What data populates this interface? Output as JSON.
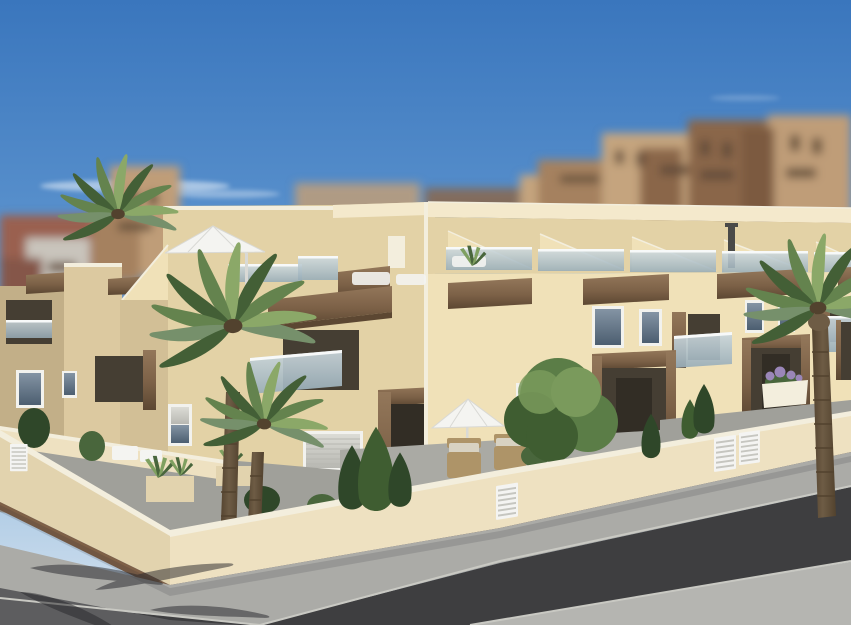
{
  "canvas": {
    "width": 851,
    "height": 625
  },
  "scene": {
    "type": "3d-architectural-exterior-render",
    "subject": "Modern two-storey cream townhouse complex with roof terraces, wooden accents, palm trees and walled front gardens on a street corner; blurred city apartment blocks behind under a blue sky",
    "time_of_day": "day",
    "elements": [
      "blue-sky",
      "wispy-clouds",
      "blurred-city-apartment-blocks",
      "townhouse-row",
      "roof-terraces",
      "sloped-roof-canopies",
      "glass-balustrades",
      "wooden-fascia-beams",
      "roof-cantilever-parasol",
      "roof-access-door",
      "chimney-flue",
      "roof-loungers",
      "balconies",
      "white-framed-windows",
      "roller-shutter-windows",
      "wooden-entrance-portals",
      "garden-walls",
      "wooden-wall-base-trim",
      "white-slatted-gates",
      "front-garden-terraces",
      "cypress-shrubs",
      "planter-boxes",
      "agave-plants",
      "flower-planter",
      "garden-parasol",
      "wicker-armchairs",
      "garden-tree",
      "palm-trees",
      "sidewalk",
      "asphalt-road",
      "far-pavement",
      "palm-frond-shadows"
    ]
  },
  "palette": {
    "skyTop": "#3a76bd",
    "skyUpper": "#5e95cf",
    "skyLower": "#a6c6e2",
    "skyHorizon": "#d6e3f0",
    "cloud": "#ffffff",
    "cityRed": "#9a6150",
    "cityRedDark": "#85564a",
    "cityGray": "#c9c4bc",
    "cityGrayLight": "#cfcbc2",
    "cityTan": "#bf9d78",
    "cityTanLight": "#c5a47e",
    "cityBrown": "#a5815f",
    "cityBrownDark": "#8a664a",
    "cityUmber": "#7c5a40",
    "citySpeck": "#5f4a38",
    "creamBright": "#f0e1b8",
    "creamLight": "#f4e9cc",
    "creamMid": "#e3d2a6",
    "creamShade": "#dcc9a0",
    "creamDark": "#d2bf96",
    "khaki": "#c2af88",
    "offWhite": "#f3eedd",
    "woodMid": "#7c6147",
    "woodLight": "#93775a",
    "woodDark": "#5c4732",
    "glassTop": "#ccd8dd",
    "glassBottom": "#98adb8",
    "railWhite": "#f7f9f9",
    "winFrame": "#f2f2ee",
    "winGlassTop": "#8494a4",
    "winGlassBottom": "#4c5e70",
    "shutterLight": "#dcdcd6",
    "shutterDark": "#b8b8b2",
    "recessDark": "#453e33",
    "doorDark": "#322d25",
    "palmMid": "#64834e",
    "palmDark": "#435f36",
    "palmLight": "#8ba868",
    "palmGray": "#76906b",
    "trunkMid": "#6e5c45",
    "trunkDark": "#52422e",
    "treeMid": "#5b7d47",
    "treeDark": "#3f5d31",
    "treeLight": "#7a9a5c",
    "bushDark": "#2f4729",
    "bushMid": "#49663c",
    "agave": "#7fa060",
    "wallCream": "#eee1c1",
    "wallShade": "#e2d3ae",
    "wallBase": "#7e6047",
    "gateWhite": "#f4f4f2",
    "gateLine": "#c6c6c0",
    "floorGray": "#a0a09a",
    "floorLight": "#aaaaa4",
    "sidewalk": "#ababa7",
    "curb": "#c9c9c3",
    "asphalt": "#3e3e40",
    "pavementFar": "#b5b5b1",
    "roadLeft": "#5d5d5f",
    "shadow": "#26262a",
    "wicker": "#ae9468",
    "cushion": "#d8d2c2",
    "parasol": "#f4f4f1",
    "parasolShade": "#d9d9d5",
    "chimney": "#4a4a48",
    "flower": "#9a86b8"
  }
}
